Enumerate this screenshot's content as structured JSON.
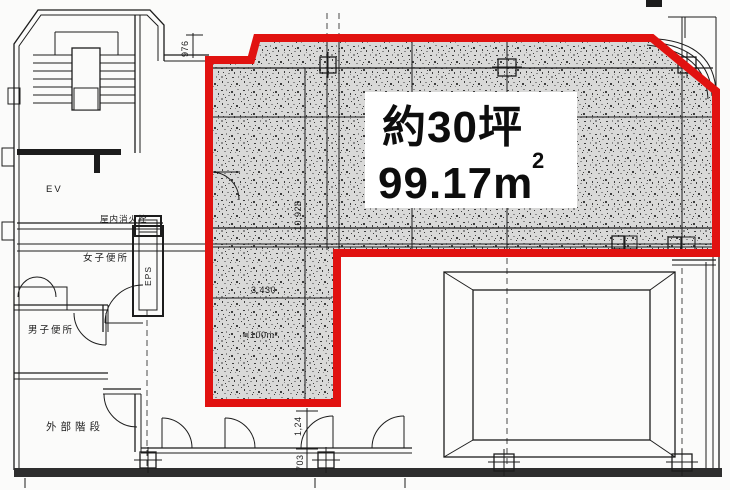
{
  "colors": {
    "background": "#fbfbfa",
    "line": "#1c1c1c",
    "red_outline": "#e11210",
    "hatch_base": "#d9d9d8",
    "hatch_speck_dark": "#3d3d3d",
    "hatch_speck_mid": "#8b8b8b",
    "label_text": "#0d0d0d",
    "wall_dark": "#2e2e2e"
  },
  "area_label": {
    "line1": "約30坪",
    "line2": "99.17m",
    "superscript": "2"
  },
  "rooms": {
    "elevator": "EV",
    "eps_shaft": "EPS",
    "indoor_fire_hydrant": "屋内消火栓",
    "womens_toilet": "女子便所",
    "mens_toilet": "男子便所",
    "external_stairs": "外部階段"
  },
  "dimensions": {
    "top_width": "976",
    "main_depth": "10,928",
    "mid_width": "3,430",
    "approx_area": "≒100m²",
    "lower_depth_1": "1,24",
    "lower_depth_2": "703"
  }
}
